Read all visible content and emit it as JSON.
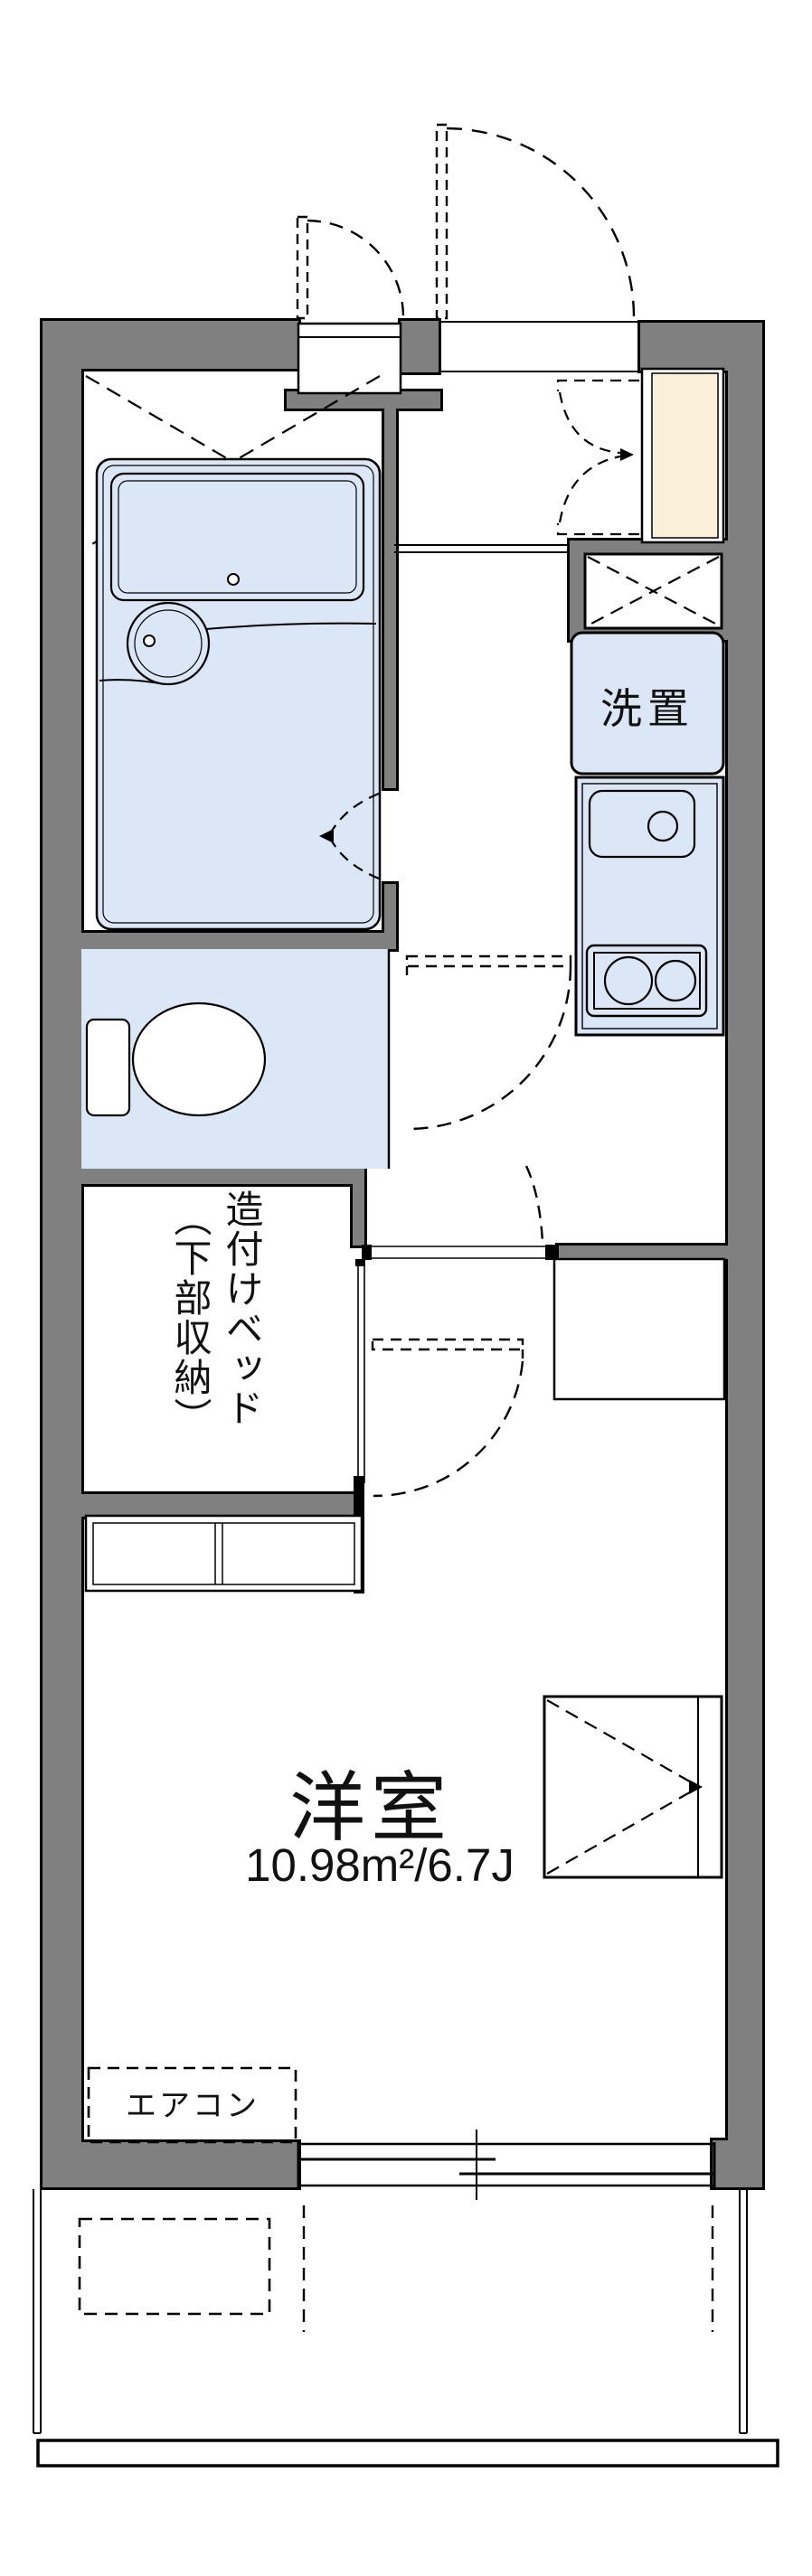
{
  "floorplan": {
    "labels": {
      "washer": "洗置",
      "bed_line1": "造付けベッド",
      "bed_line2": "（下部収納）",
      "room_name": "洋室",
      "room_area": "10.98m²/6.7J",
      "aircon": "エアコン"
    },
    "colors": {
      "wall": "#808080",
      "room_fill": "#dbe7f7",
      "cabinet_fill": "#fbf1da"
    }
  }
}
